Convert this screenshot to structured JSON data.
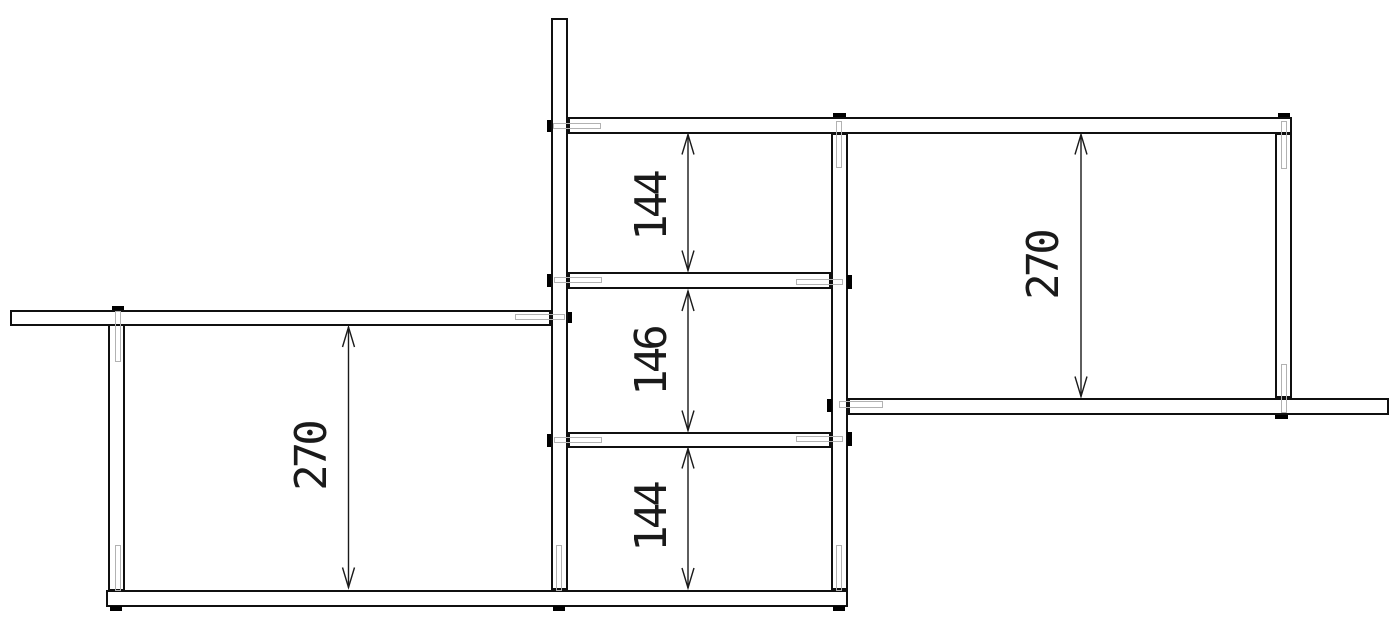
{
  "drawing": {
    "canvas": {
      "width": 1400,
      "height": 639,
      "background": "#ffffff"
    },
    "style": {
      "outline_color": "#101010",
      "part_fill": "#ffffff",
      "hidden_dowel_color": "#b2b2b2",
      "plug_color": "#000000",
      "dimension_color": "#1a1a1a",
      "arrow_length": 20,
      "arrow_half_width": 6
    },
    "posts": [
      {
        "id": "post-left",
        "x": 108,
        "y": 324,
        "w": 16.5,
        "h": 266.5
      },
      {
        "id": "post-center",
        "x": 551,
        "y": 17.5,
        "w": 17,
        "h": 572.5
      },
      {
        "id": "post-mid-right",
        "x": 831,
        "y": 133,
        "w": 16.5,
        "h": 457
      },
      {
        "id": "post-right",
        "x": 1274.5,
        "y": 133,
        "w": 17.5,
        "h": 265
      }
    ],
    "shelves": [
      {
        "id": "shelf-top",
        "x": 568,
        "y": 116.5,
        "w": 724,
        "h": 17
      },
      {
        "id": "shelf-upper-mid",
        "x": 568,
        "y": 272,
        "w": 263,
        "h": 17
      },
      {
        "id": "shelf-left",
        "x": 10,
        "y": 309.5,
        "w": 541,
        "h": 16.5
      },
      {
        "id": "shelf-right",
        "x": 847.5,
        "y": 397.5,
        "w": 541.5,
        "h": 17
      },
      {
        "id": "shelf-lower-mid",
        "x": 568,
        "y": 431.5,
        "w": 263,
        "h": 16.5
      },
      {
        "id": "shelf-bottom",
        "x": 106,
        "y": 589.5,
        "w": 742,
        "h": 17
      }
    ],
    "dowels": [
      {
        "id": "dowel-left-post-top",
        "x": 114.5,
        "y": 311,
        "w": 6,
        "h": 51
      },
      {
        "id": "dowel-left-post-bottom",
        "x": 114.5,
        "y": 545,
        "w": 6,
        "h": 46
      },
      {
        "id": "dowel-center-post-shelf-top",
        "x": 553,
        "y": 122.5,
        "w": 48,
        "h": 6
      },
      {
        "id": "dowel-center-post-shelf-left",
        "x": 515,
        "y": 313.5,
        "w": 50,
        "h": 6
      },
      {
        "id": "dowel-center-post-shelf-upper-mid",
        "x": 554,
        "y": 276.5,
        "w": 48,
        "h": 6
      },
      {
        "id": "dowel-center-post-shelf-lower-mid",
        "x": 554,
        "y": 436.5,
        "w": 48,
        "h": 6
      },
      {
        "id": "dowel-center-post-bottom",
        "x": 555.5,
        "y": 545,
        "w": 6,
        "h": 46
      },
      {
        "id": "dowel-midright-post-shelf-top",
        "x": 836,
        "y": 120.5,
        "w": 6,
        "h": 47
      },
      {
        "id": "dowel-midright-post-shelf-upper-mid",
        "x": 796,
        "y": 278.5,
        "w": 47,
        "h": 6
      },
      {
        "id": "dowel-midright-post-shelf-right",
        "x": 839,
        "y": 401,
        "w": 44,
        "h": 6.5
      },
      {
        "id": "dowel-midright-post-shelf-lower-mid",
        "x": 796,
        "y": 436,
        "w": 47,
        "h": 6
      },
      {
        "id": "dowel-midright-post-bottom",
        "x": 836,
        "y": 545,
        "w": 6,
        "h": 46
      },
      {
        "id": "dowel-right-post-top",
        "x": 1280.5,
        "y": 120.5,
        "w": 6,
        "h": 48
      },
      {
        "id": "dowel-right-post-bottom",
        "x": 1280.5,
        "y": 363.5,
        "w": 6,
        "h": 49
      }
    ],
    "plugs": [
      {
        "id": "plug-left-post-top",
        "x": 111.5,
        "y": 305.5,
        "w": 12.5,
        "h": 4.5
      },
      {
        "id": "plug-left-post-foot",
        "x": 109.5,
        "y": 606,
        "w": 12.5,
        "h": 4.5
      },
      {
        "id": "plug-center-post-shelf-top",
        "x": 546.5,
        "y": 120,
        "w": 4.5,
        "h": 12
      },
      {
        "id": "plug-center-post-shelf-left",
        "x": 567.5,
        "y": 311.5,
        "w": 4.5,
        "h": 11.5
      },
      {
        "id": "plug-center-post-shelf-upper-mid",
        "x": 546.5,
        "y": 274,
        "w": 4.5,
        "h": 13
      },
      {
        "id": "plug-center-post-shelf-lower-mid",
        "x": 546.5,
        "y": 433.5,
        "w": 4.5,
        "h": 13
      },
      {
        "id": "plug-center-post-foot",
        "x": 552.5,
        "y": 606,
        "w": 12.5,
        "h": 4.5
      },
      {
        "id": "plug-midright-post-top",
        "x": 833,
        "y": 112.5,
        "w": 12.5,
        "h": 4.5
      },
      {
        "id": "plug-midright-post-shelf-upper-mid",
        "x": 847,
        "y": 275,
        "w": 4.5,
        "h": 13.5
      },
      {
        "id": "plug-midright-post-shelf-right",
        "x": 827,
        "y": 398.5,
        "w": 4.5,
        "h": 13.5
      },
      {
        "id": "plug-midright-post-shelf-lower-mid",
        "x": 847,
        "y": 432,
        "w": 4.5,
        "h": 13.5
      },
      {
        "id": "plug-midright-post-foot",
        "x": 832.5,
        "y": 606,
        "w": 12.5,
        "h": 4.5
      },
      {
        "id": "plug-right-post-top",
        "x": 1277.5,
        "y": 112.5,
        "w": 12.5,
        "h": 4.5
      },
      {
        "id": "plug-right-post-under-shelf",
        "x": 1274.5,
        "y": 414.5,
        "w": 13,
        "h": 4.5
      }
    ],
    "dimensions": [
      {
        "id": "dim-left-270",
        "label": "270",
        "x": 348.5,
        "y1": 327,
        "y2": 587.5,
        "lx": 312,
        "ly": 457
      },
      {
        "id": "dim-mid-top-144",
        "label": "144",
        "x": 688,
        "y1": 134.5,
        "y2": 270.5,
        "lx": 652,
        "ly": 207
      },
      {
        "id": "dim-mid-146",
        "label": "146",
        "x": 688,
        "y1": 291,
        "y2": 430.5,
        "lx": 652,
        "ly": 362
      },
      {
        "id": "dim-mid-bottom-144",
        "label": "144",
        "x": 688,
        "y1": 448.5,
        "y2": 588,
        "lx": 652,
        "ly": 518
      },
      {
        "id": "dim-right-270",
        "label": "270",
        "x": 1081,
        "y1": 134.5,
        "y2": 396.5,
        "lx": 1044,
        "ly": 266
      }
    ]
  }
}
